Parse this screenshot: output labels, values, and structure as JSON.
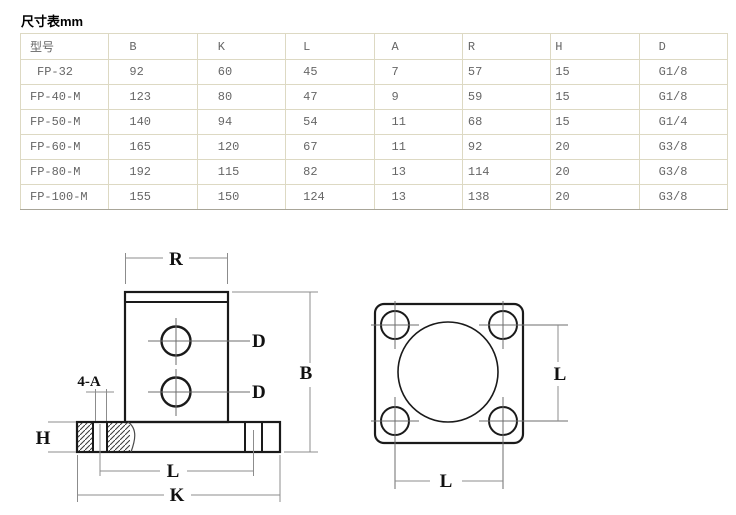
{
  "page": {
    "title": "尺寸表mm"
  },
  "table": {
    "columns": [
      "型号",
      "B",
      "K",
      "L",
      "A",
      "R",
      "H",
      "D"
    ],
    "rows": [
      [
        "FP-32",
        "92",
        "60",
        "45",
        "7",
        "57",
        "15",
        "G1/8"
      ],
      [
        "FP-40-M",
        "123",
        "80",
        "47",
        "9",
        "59",
        "15",
        "G1/8"
      ],
      [
        "FP-50-M",
        "140",
        "94",
        "54",
        "11",
        "68",
        "15",
        "G1/4"
      ],
      [
        "FP-60-M",
        "165",
        "120",
        "67",
        "11",
        "92",
        "20",
        "G3/8"
      ],
      [
        "FP-80-M",
        "192",
        "115",
        "82",
        "13",
        "114",
        "20",
        "G3/8"
      ],
      [
        "FP-100-M",
        "155",
        "150",
        "124",
        "13",
        "138",
        "20",
        "G3/8"
      ]
    ]
  },
  "diagram": {
    "front_view": {
      "top_width_label": "R",
      "height_label": "B",
      "port_label": "D",
      "mount_holes_label": "4-A",
      "flange_thickness_label": "H",
      "hole_span_label": "L",
      "flange_width_label": "K"
    },
    "top_view": {
      "vertical_span_label": "L",
      "horizontal_span_label": "L"
    },
    "colors": {
      "outline": "#1a1a1a",
      "dimension_line": "#8c8c8c",
      "table_border": "#ddd9c3",
      "table_text": "#666666"
    }
  }
}
